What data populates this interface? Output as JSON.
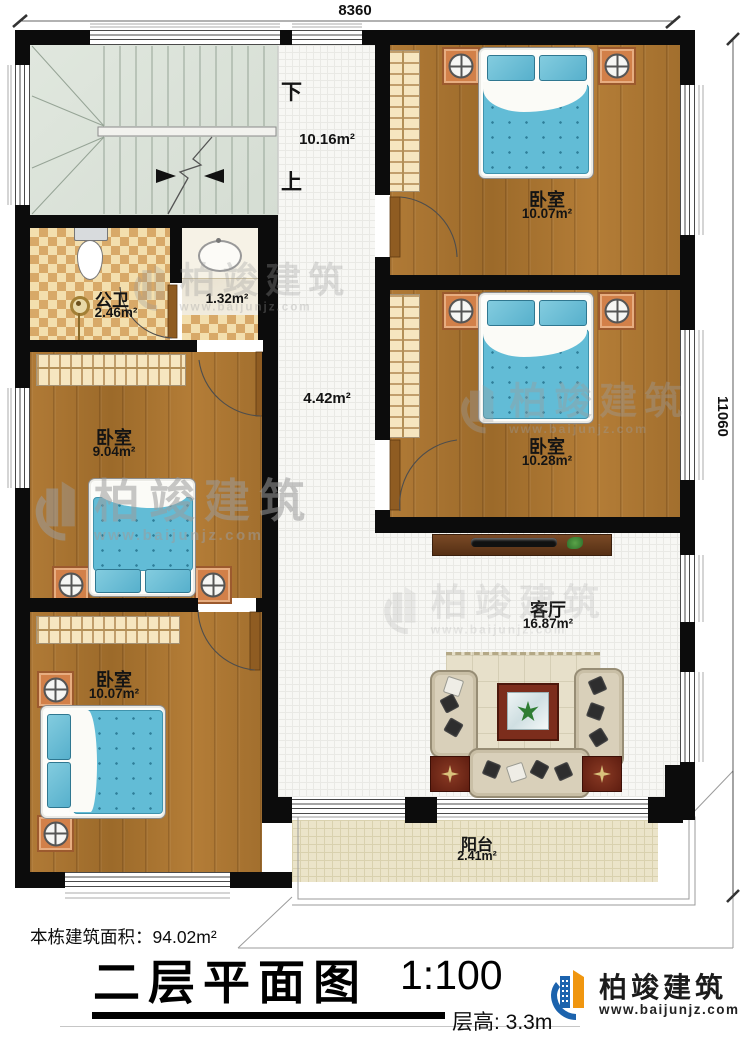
{
  "dimensions": {
    "top": "8360",
    "right": "11060"
  },
  "stairs": {
    "down": "下",
    "up": "上"
  },
  "areas": {
    "stair_hall": "10.16m²",
    "corridor": "4.42m²"
  },
  "rooms": {
    "bedroom_top_right": {
      "name": "卧室",
      "area": "10.07m²"
    },
    "bedroom_mid_right": {
      "name": "卧室",
      "area": "10.28m²"
    },
    "bedroom_mid_left": {
      "name": "卧室",
      "area": "9.04m²"
    },
    "bedroom_bottom_left": {
      "name": "卧室",
      "area": "10.07m²"
    },
    "bathroom": {
      "name": "公卫",
      "area": "2.46m²"
    },
    "washroom": {
      "area": "1.32m²"
    },
    "living_room": {
      "name": "客厅",
      "area": "16.87m²"
    },
    "balcony": {
      "name": "阳台",
      "area": "2.41m²"
    }
  },
  "footer": {
    "building_area": "本栋建筑面积：94.02m²",
    "title": "二层平面图",
    "scale": "1:100",
    "floor_height": "层高: 3.3m"
  },
  "brand": {
    "name": "柏竣建筑",
    "website": "www.baijunjz.com"
  },
  "watermark": {
    "name": "柏竣建筑",
    "website": "www.baijunjz.com"
  },
  "colors": {
    "wall": "#0c0c0c",
    "wood_floor": "#a9732e",
    "bed_blue": "#62bcd6",
    "brand_blue": "#1c63ad",
    "brand_orange": "#f0960f"
  }
}
